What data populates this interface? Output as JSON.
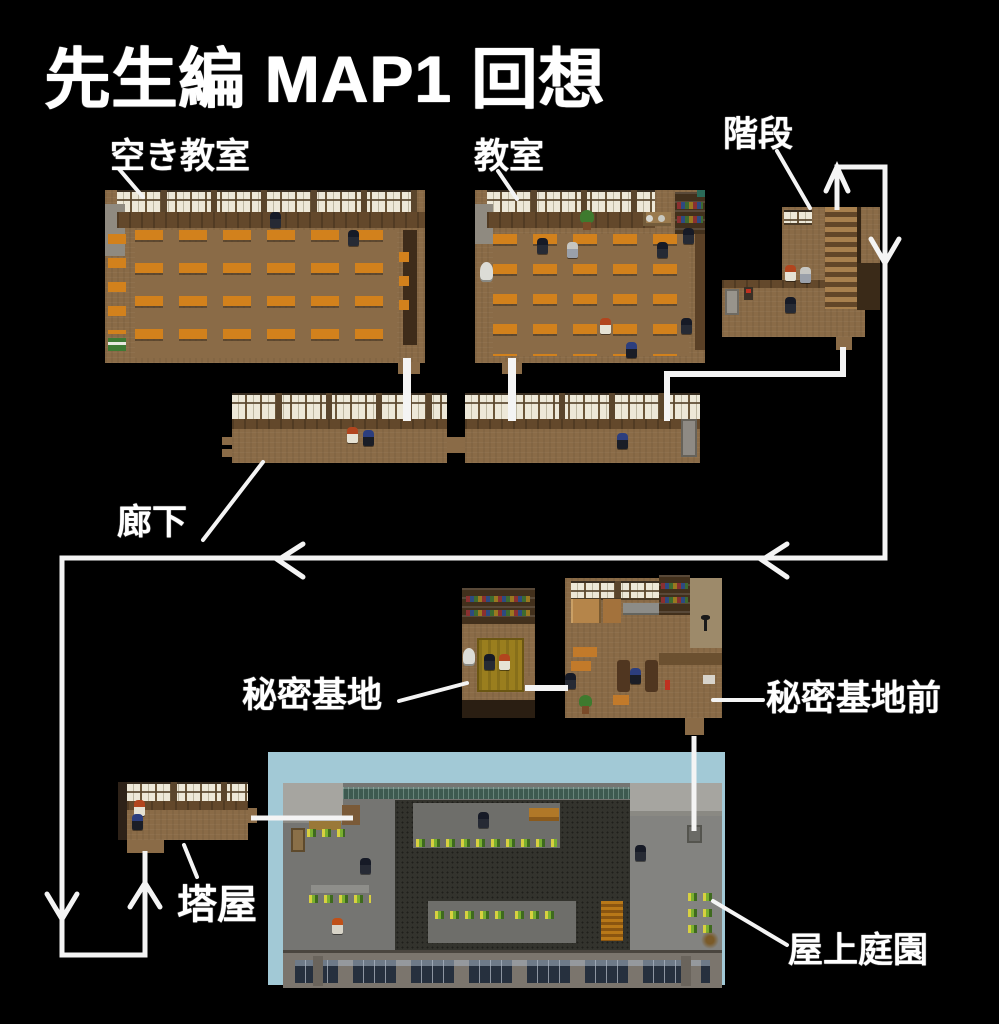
{
  "title": "先生編 MAP1 回想",
  "labels": {
    "empty_classroom": "空き教室",
    "classroom": "教室",
    "stairs": "階段",
    "corridor": "廊下",
    "secret_base": "秘密基地",
    "secret_base_front": "秘密基地前",
    "tower_room": "塔屋",
    "rooftop_garden": "屋上庭園"
  },
  "colors": {
    "background": "#000000",
    "flow_line": "#f4f4f4",
    "label_text": "#ffffff",
    "wood_floor": "#8a6b47",
    "desk_orange": "#d2811c",
    "window_pane": "#ece7d7",
    "sky_panel": "#a2c9d6",
    "roof_concrete": "#757572",
    "garden_soil": "#33332d",
    "tatami_mat": "#9a7e1e"
  }
}
